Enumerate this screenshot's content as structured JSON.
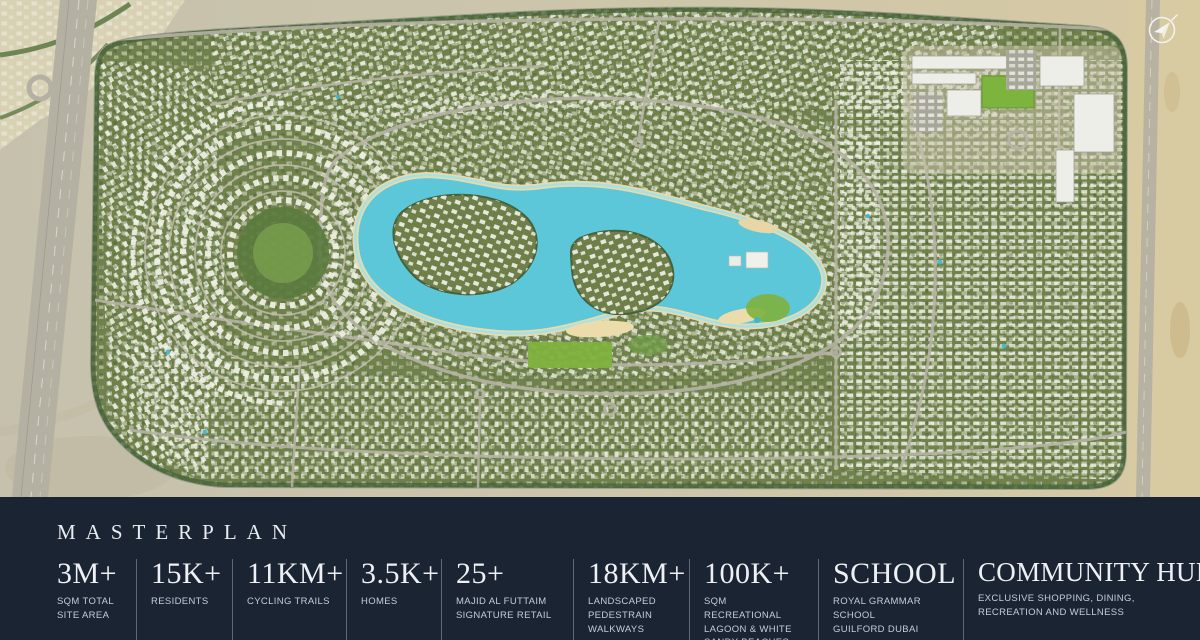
{
  "map": {
    "description": "aerial-masterplan-satellite-view",
    "compass_icon": "north-arrow",
    "colors": {
      "desert": "#cdc6ab",
      "desert_right": "#d8caa1",
      "greenery": "#71814b",
      "villas": "#f1f2e9",
      "lagoon": "#5cc7d9",
      "beach": "#ead9aa",
      "roads": "#b6b3a5"
    }
  },
  "panel": {
    "title": "MASTERPLAN",
    "background": "#1a2433",
    "stats": [
      {
        "value": "3M+",
        "label": "SQM TOTAL SITE AREA"
      },
      {
        "value": "15K+",
        "label": "RESIDENTS"
      },
      {
        "value": "11KM+",
        "label": "CYCLING TRAILS"
      },
      {
        "value": "3.5K+",
        "label": "HOMES"
      },
      {
        "value": "25+",
        "label": "MAJID AL FUTTAIM SIGNATURE RETAIL"
      },
      {
        "value": "18KM+",
        "label": "LANDSCAPED PEDESTRAIN WALKWAYS"
      },
      {
        "value": "100K+",
        "label": "SQM RECREATIONAL LAGOON & WHITE SANDY BEACHES"
      },
      {
        "value": "SCHOOL",
        "label": "ROYAL GRAMMAR SCHOOL GUILFORD DUBAI"
      },
      {
        "value": "COMMUNITY HUB",
        "label": "EXCLUSIVE SHOPPING, DINING, RECREATION AND WELLNESS"
      }
    ]
  }
}
